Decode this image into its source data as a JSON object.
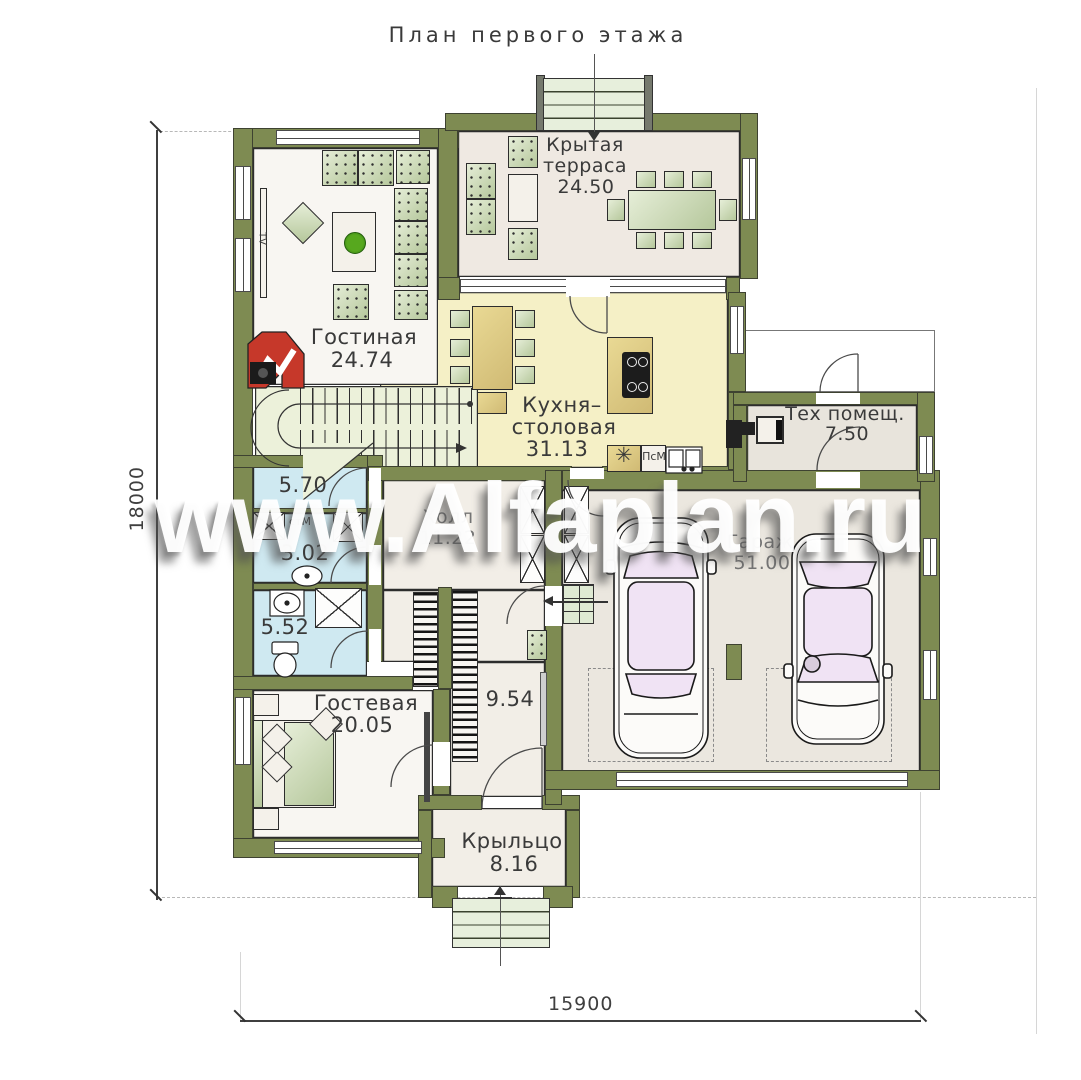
{
  "title": "План первого этажа",
  "watermark": "www.Alfaplan.ru",
  "dimensions": {
    "height_mm": "18000",
    "width_mm": "15900"
  },
  "rooms": {
    "living": {
      "name": "Гостиная",
      "area": "24.74"
    },
    "terrace": {
      "name1": "Крытая",
      "name2": "терраса",
      "area": "24.50"
    },
    "kitchen": {
      "name1": "Кухня–",
      "name2": "столовая",
      "area": "31.13"
    },
    "tech": {
      "name": "Тех помещ.",
      "area": "7.50"
    },
    "hall": {
      "name": "Холл",
      "area": "11.22"
    },
    "garage": {
      "name": "Гараж",
      "area": "51.00"
    },
    "laundry": {
      "area": "5.70"
    },
    "wc": {
      "area": "3.02"
    },
    "bathroom": {
      "area": "5.52"
    },
    "guest": {
      "name": "Гостевая",
      "area": "20.05"
    },
    "corridor": {
      "area": "9.54"
    },
    "porch": {
      "name": "Крыльцо",
      "area": "8.16"
    }
  },
  "appliances": {
    "tv": "TV",
    "washer": "стМ",
    "dishwasher": "ПсМ",
    "stove": "✳"
  },
  "colors": {
    "wall": "#7e8b52",
    "kitchen_floor": "#f5f0c6",
    "wet_floor": "#cfe9f1",
    "terrace_floor": "#efe9e2",
    "hall_floor": "#f2eee7",
    "garage_floor": "#ebe7df",
    "tech_floor": "#e8e4dc",
    "stairs_floor": "#ecf1da",
    "living_floor": "#f8f6f2",
    "fireplace": "#c6382a",
    "furniture": "#c9d6ae",
    "car_glass": "#f0e3f4"
  }
}
